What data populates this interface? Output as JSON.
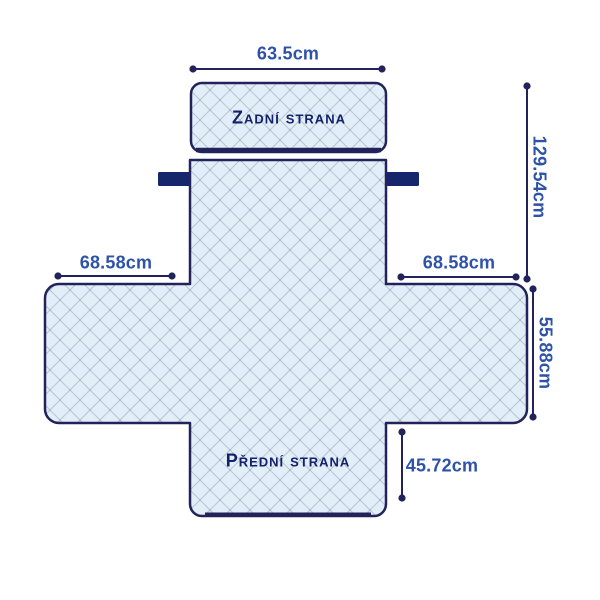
{
  "diagram": {
    "title": "sofa-cover-dimension-diagram",
    "back_label": "Zadní strana",
    "front_label": "Přední strana",
    "dims": {
      "top_width": "63.5cm",
      "total_height": "129.54cm",
      "left_arm_width": "68.58cm",
      "right_arm_width": "68.58cm",
      "arm_height": "55.88cm",
      "front_height": "45.72cm"
    },
    "colors": {
      "outline": "#23235c",
      "fabric": "#e2eef8",
      "quilt_line": "#b9c6d2",
      "strap": "#16266b",
      "dimension_text": "#2d52a8",
      "label_text": "#15216b",
      "background": "#ffffff"
    }
  }
}
